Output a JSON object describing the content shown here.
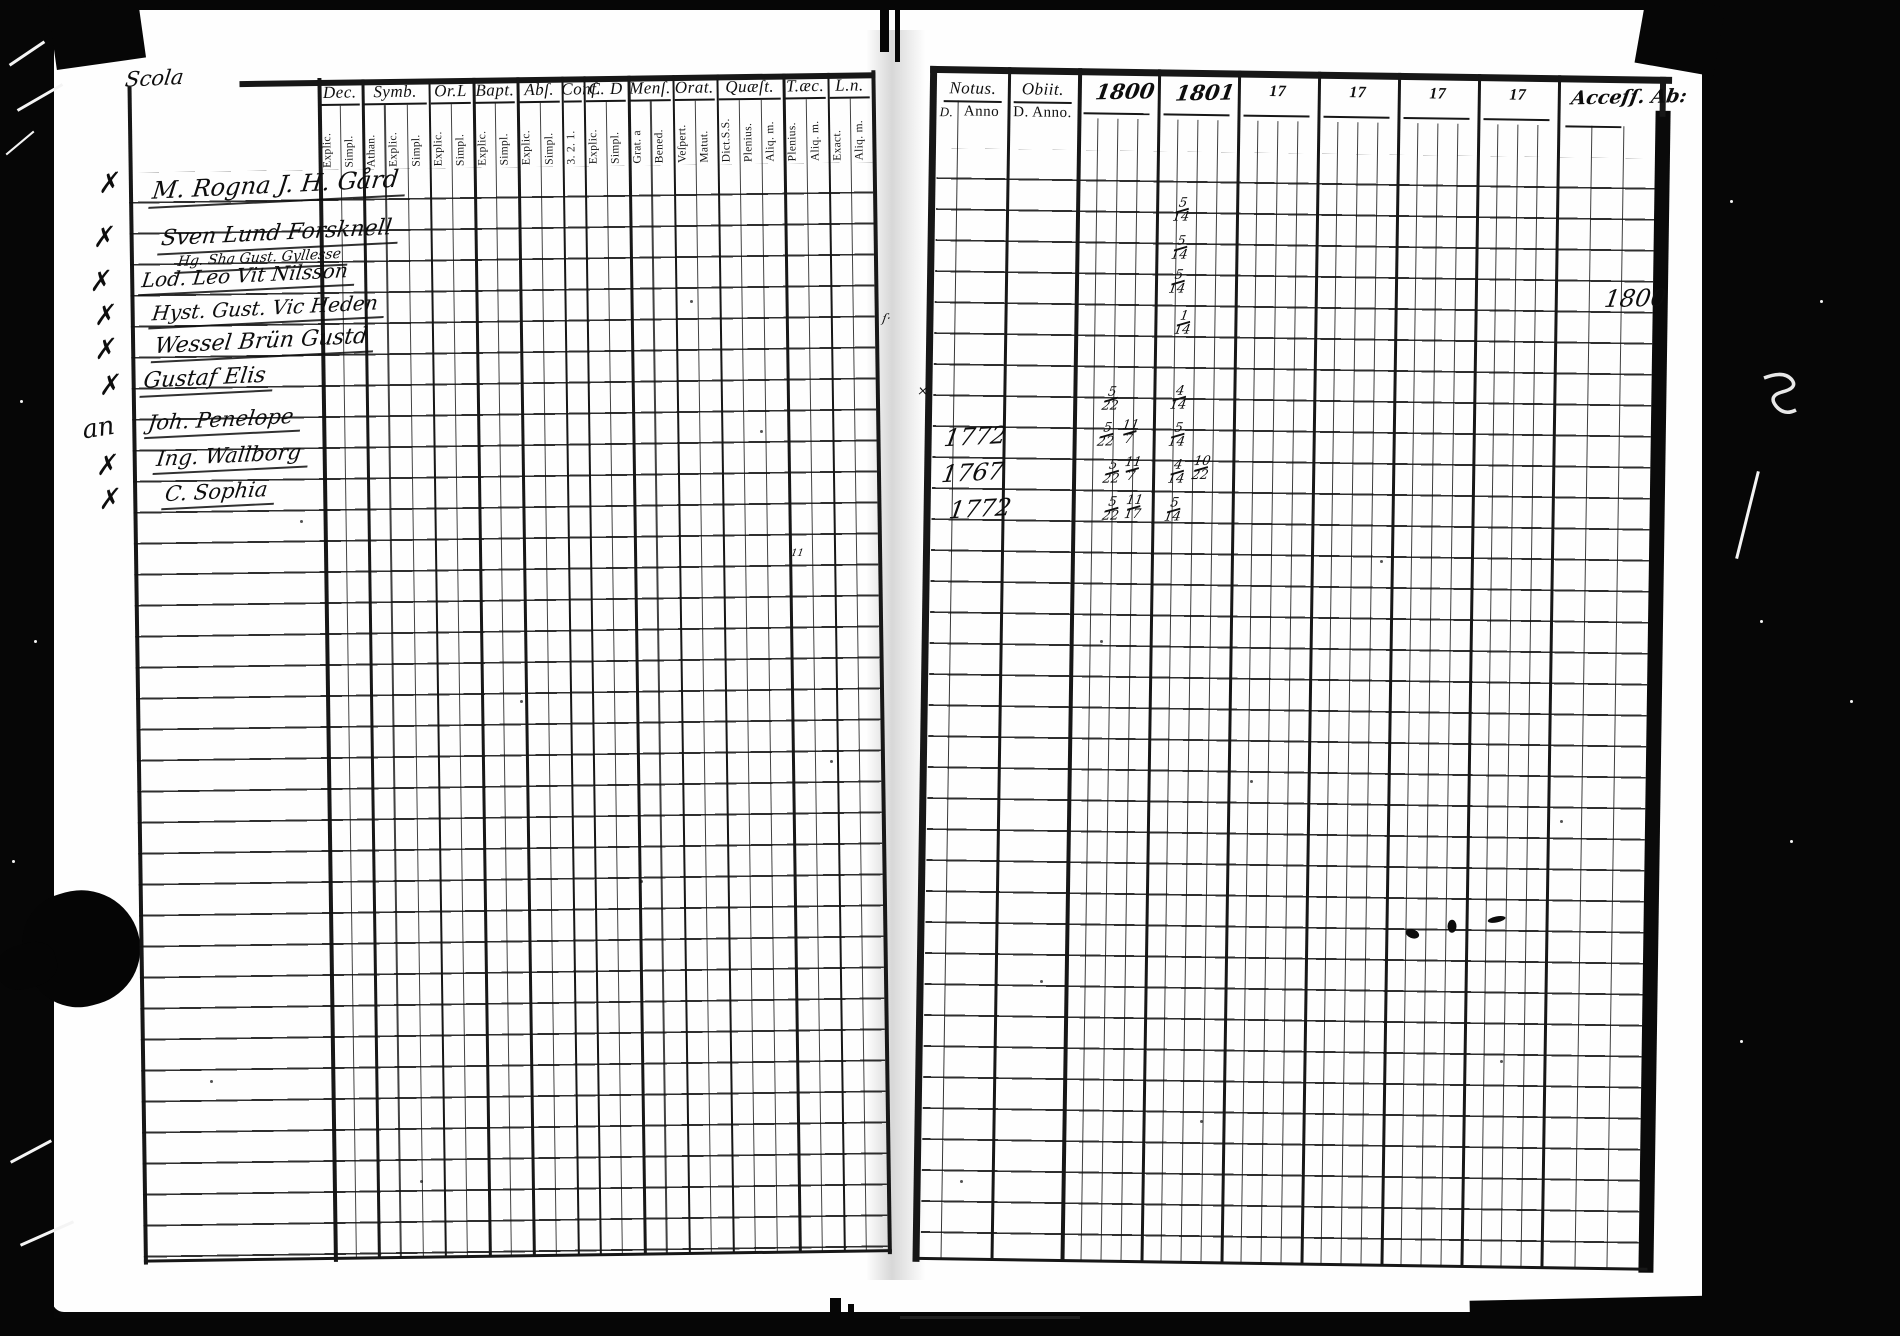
{
  "left_page": {
    "margin_title": "Scola",
    "columns": [
      {
        "label": "Dec.",
        "subs": [
          "Explic.",
          "Simpl."
        ]
      },
      {
        "label": "Symb.",
        "subs": [
          "Athan.",
          "Explic.",
          "Simpl."
        ]
      },
      {
        "label": "Or.L",
        "subs": [
          "Explic.",
          "Simpl."
        ]
      },
      {
        "label": "Bapt.",
        "subs": [
          "Explic.",
          "Simpl."
        ]
      },
      {
        "label": "Abſ.",
        "subs": [
          "Explic.",
          "Simpl."
        ]
      },
      {
        "label": "Conf.",
        "subs": [
          "3. 2. 1."
        ]
      },
      {
        "label": "C. D",
        "subs": [
          "Explic.",
          "Simpl."
        ]
      },
      {
        "label": "Menſ.",
        "subs": [
          "Grat. a",
          "Bened."
        ]
      },
      {
        "label": "Orat.",
        "subs": [
          "Veſpert.",
          "Matut."
        ]
      },
      {
        "label": "Quæſt.",
        "subs": [
          "Dict.S.S.",
          "Plenius.",
          "Aliq. m."
        ]
      },
      {
        "label": "T.æc.",
        "subs": [
          "Plenius.",
          "Aliq. m."
        ]
      },
      {
        "label": "L.n.",
        "subs": [
          "Exact.",
          "Aliq. m."
        ]
      }
    ],
    "names": [
      {
        "mark": "✗",
        "mx": 96,
        "my": 166,
        "text": "M. Rogna J. H. Gård",
        "x": 150,
        "y": 170,
        "size": 24
      },
      {
        "mark": "✗",
        "mx": 90,
        "my": 220,
        "text": "Sven Lund Forsknell",
        "x": 158,
        "y": 220,
        "size": 22
      },
      {
        "mark": "",
        "mx": 0,
        "my": 0,
        "text": "Hg. Sha Gust. Gyllesse",
        "x": 174,
        "y": 249,
        "size": 14
      },
      {
        "mark": "✗",
        "mx": 86,
        "my": 264,
        "text": "Lod. Leo Vit Nilsson",
        "x": 138,
        "y": 262,
        "size": 20
      },
      {
        "mark": "✗",
        "mx": 90,
        "my": 298,
        "text": "Hyst. Gust. Vic Heden",
        "x": 148,
        "y": 295,
        "size": 20
      },
      {
        "mark": "✗",
        "mx": 90,
        "my": 332,
        "text": "Wessel Brün Gustd",
        "x": 150,
        "y": 328,
        "size": 22
      },
      {
        "mark": "✗",
        "mx": 94,
        "my": 368,
        "text": "Gustaf Elis",
        "x": 138,
        "y": 364,
        "size": 22
      },
      {
        "mark": "an",
        "mx": 78,
        "my": 410,
        "text": "Joh. Penelope",
        "x": 142,
        "y": 406,
        "size": 21
      },
      {
        "mark": "✗",
        "mx": 90,
        "my": 448,
        "text": "Ing. Wallborg",
        "x": 150,
        "y": 442,
        "size": 21
      },
      {
        "mark": "✗",
        "mx": 92,
        "my": 482,
        "text": "C. Sophia",
        "x": 158,
        "y": 478,
        "size": 21
      }
    ]
  },
  "right_page": {
    "header": {
      "notus_label": "Notus.",
      "notus_sub_left": "D.",
      "notus_sub_right": "Anno",
      "obiit_label": "Obiit.",
      "obiit_sub": "D. Anno.",
      "years": [
        "1800",
        "1801",
        "17",
        "17",
        "17",
        "17"
      ],
      "access_label": "Acceſſ. Ab:"
    },
    "anno_entries": [
      {
        "text": "1772",
        "x": 950,
        "y": 422
      },
      {
        "text": "1767",
        "x": 948,
        "y": 458
      },
      {
        "text": "1772",
        "x": 956,
        "y": 494
      }
    ],
    "date_entries": [
      {
        "col": "1801",
        "text": "5/14",
        "x": 1176,
        "y": 188
      },
      {
        "col": "1801",
        "text": "5/14",
        "x": 1175,
        "y": 226
      },
      {
        "col": "1801",
        "text": "5/14",
        "x": 1173,
        "y": 260
      },
      {
        "col": "1801",
        "text": "1/14",
        "x": 1179,
        "y": 301
      },
      {
        "col": "1800",
        "text": "5/22",
        "x": 1108,
        "y": 378
      },
      {
        "col": "1801",
        "text": "4/14",
        "x": 1176,
        "y": 376
      },
      {
        "col": "1800",
        "text": "5/22",
        "x": 1104,
        "y": 414
      },
      {
        "col": "1800",
        "text": "11/7",
        "x": 1127,
        "y": 411
      },
      {
        "col": "1801",
        "text": "5/14",
        "x": 1175,
        "y": 413
      },
      {
        "col": "1800",
        "text": "5/22",
        "x": 1110,
        "y": 451
      },
      {
        "col": "1800",
        "text": "11/7",
        "x": 1130,
        "y": 448
      },
      {
        "col": "1801",
        "text": "4/14",
        "x": 1175,
        "y": 450
      },
      {
        "col": "1801",
        "text": "10/22",
        "x": 1199,
        "y": 446
      },
      {
        "col": "1800",
        "text": "5/22",
        "x": 1110,
        "y": 488
      },
      {
        "col": "1800",
        "text": "11/17",
        "x": 1132,
        "y": 486
      },
      {
        "col": "1801",
        "text": "5/14",
        "x": 1172,
        "y": 488
      }
    ],
    "access_year": {
      "text": "1800",
      "x": 1608,
      "y": 274
    },
    "stray_marks": [
      {
        "text": "×",
        "x": 922,
        "y": 384,
        "size": 13
      },
      {
        "text": "ſ·",
        "x": 886,
        "y": 312,
        "size": 12
      },
      {
        "text": "11",
        "x": 798,
        "y": 550,
        "size": 10
      }
    ]
  }
}
